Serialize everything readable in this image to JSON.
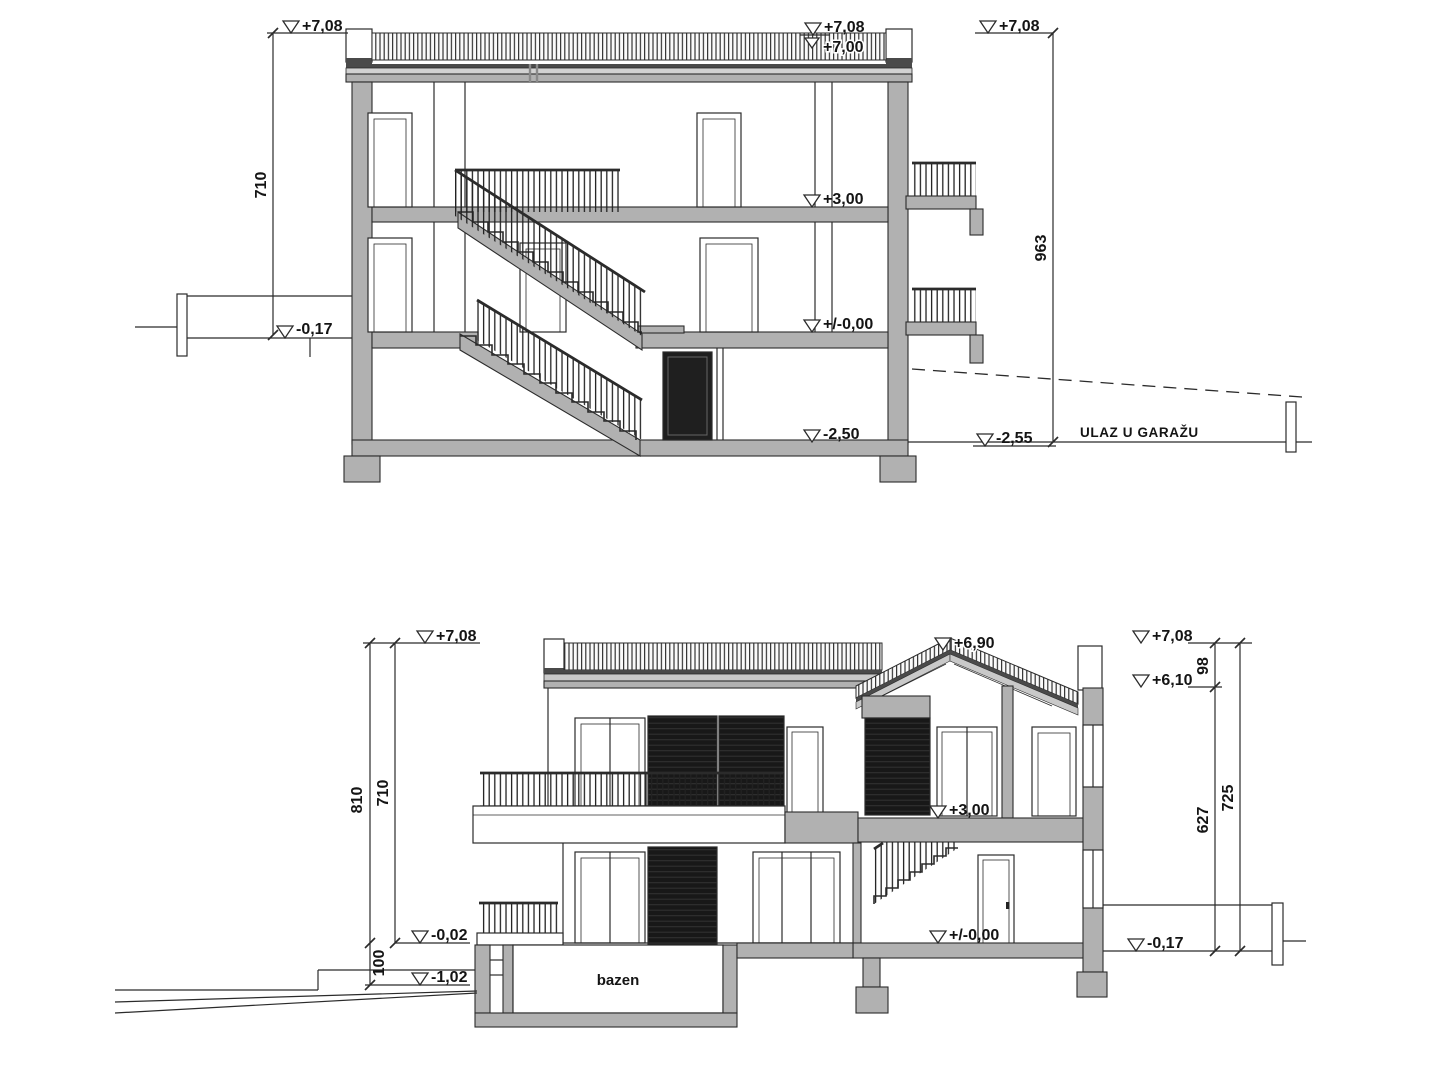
{
  "drawing_meta": {
    "background": "#ffffff",
    "line_color": "#2b2b2b",
    "wall_fill": "#b1b1b1",
    "shutter_color": "#181818"
  },
  "top_section": {
    "level_marks": {
      "left_top": "+7,08",
      "roof_top": "+7,08",
      "roof_slab": "+7,00",
      "right_top": "+7,08",
      "first_floor": "+3,00",
      "ground_floor": "+/-0,00",
      "terrace_left": "-0,17",
      "basement": "-2,50",
      "garage_entry": "-2,55"
    },
    "dimensions": {
      "left_height": "710",
      "right_height": "963"
    },
    "labels": {
      "garage_entrance": "ULAZ U GARAŽU"
    }
  },
  "bottom_section": {
    "level_marks": {
      "left_top": "+7,08",
      "ridge": "+6,90",
      "right_top": "+7,08",
      "eave": "+6,10",
      "first_floor": "+3,00",
      "terrace_small": "-0,02",
      "ground_left": "-1,02",
      "ground_floor": "+/-0,00",
      "terrace_right": "-0,17"
    },
    "dimensions": {
      "left_total": "810",
      "left_upper": "710",
      "left_step": "100",
      "roof_offset": "98",
      "right_lower": "627",
      "right_total": "725"
    },
    "labels": {
      "pool": "bazen"
    }
  }
}
